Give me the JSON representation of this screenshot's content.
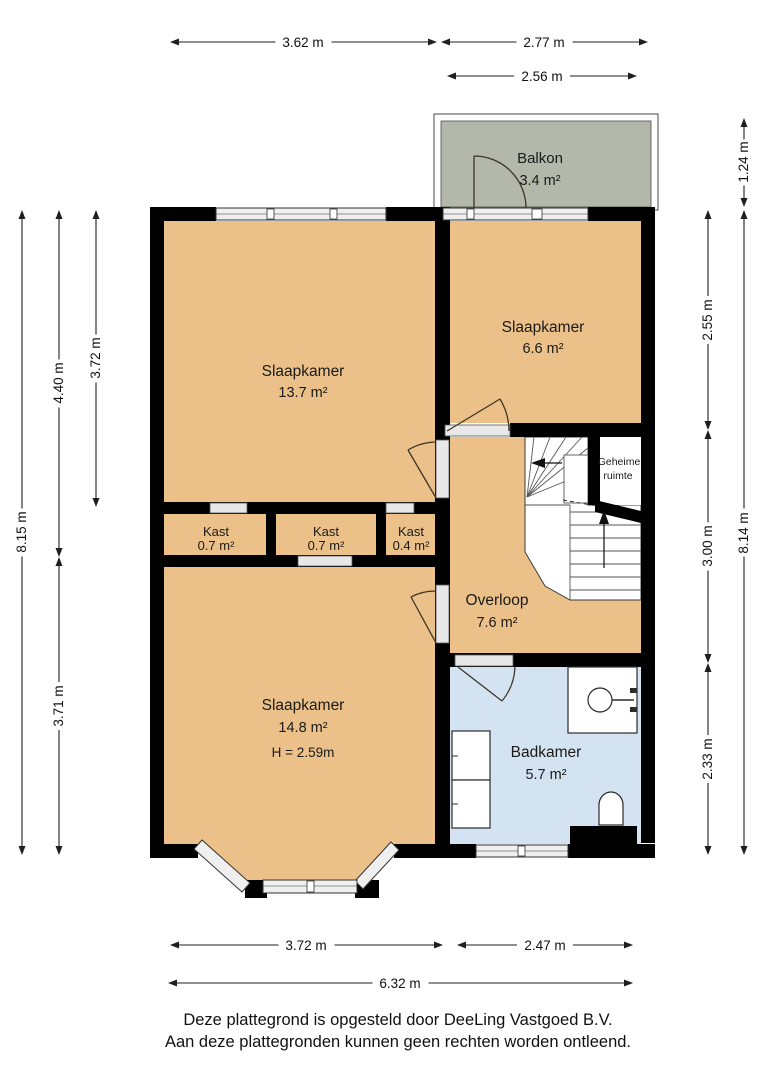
{
  "plan": {
    "rooms": {
      "balkon": {
        "name": "Balkon",
        "area": "3.4 m²"
      },
      "slaapkamer_groot_boven": {
        "name": "Slaapkamer",
        "area": "13.7 m²"
      },
      "slaapkamer_klein": {
        "name": "Slaapkamer",
        "area": "6.6 m²"
      },
      "geheime_ruimte": {
        "line1": "Geheime",
        "line2": "ruimte"
      },
      "kast_links": {
        "name": "Kast",
        "area": "0.7 m²"
      },
      "kast_midden": {
        "name": "Kast",
        "area": "0.7 m²"
      },
      "kast_rechts": {
        "name": "Kast",
        "area": "0.4 m²"
      },
      "overloop": {
        "name": "Overloop",
        "area": "7.6 m²"
      },
      "slaapkamer_groot_onder": {
        "name": "Slaapkamer",
        "area": "14.8 m²",
        "height": "H = 2.59m"
      },
      "badkamer": {
        "name": "Badkamer",
        "area": "5.7 m²"
      }
    },
    "dimensions": {
      "top_left": "3.62 m",
      "top_right": "2.77 m",
      "balcony_width": "2.56 m",
      "balcony_depth": "1.24 m",
      "right_upper": "2.55 m",
      "right_middle": "3.00 m",
      "right_lower": "2.33 m",
      "right_total": "8.14 m",
      "left_total": "8.15 m",
      "left_upper": "4.40 m",
      "left_upper_inner": "3.72 m",
      "left_lower": "3.71 m",
      "bottom_left": "3.72 m",
      "bottom_right": "2.47 m",
      "bottom_total": "6.32 m"
    },
    "footer": {
      "line1": "Deze plattegrond is opgesteld door DeeLing Vastgoed B.V.",
      "line2": "Aan deze plattegronden kunnen geen rechten worden ontleend."
    },
    "colors": {
      "room_fill": "#ebc189",
      "bathroom_fill": "#d4e3f1",
      "balcony_fill": "#b4b8ab",
      "wall": "#000000"
    }
  }
}
